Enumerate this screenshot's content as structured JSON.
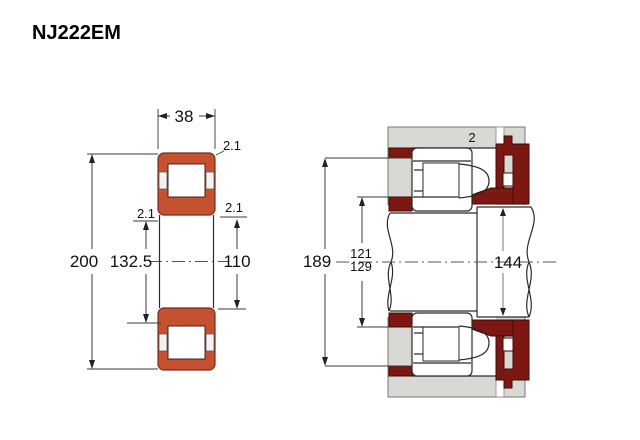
{
  "title": "NJ222EM",
  "left_view": {
    "width_label": "38",
    "outer_diameter_label": "200",
    "rib_diameter_label": "132.5",
    "bore_diameter_label": "110",
    "chamfer_top_label": "2.1",
    "chamfer_left_label": "2.1",
    "chamfer_right_label": "2.1"
  },
  "right_view": {
    "groove_width_label": "2",
    "housing_abutment_label": "189",
    "shaft_abutment_min_label": "121",
    "shaft_abutment_max_label": "129",
    "collar_diameter_label": "144"
  },
  "colors": {
    "bearing_ring": "#c4512f",
    "abutment": "#7d1712",
    "housing": "#d8d8d5",
    "cavity": "#ffffff"
  }
}
